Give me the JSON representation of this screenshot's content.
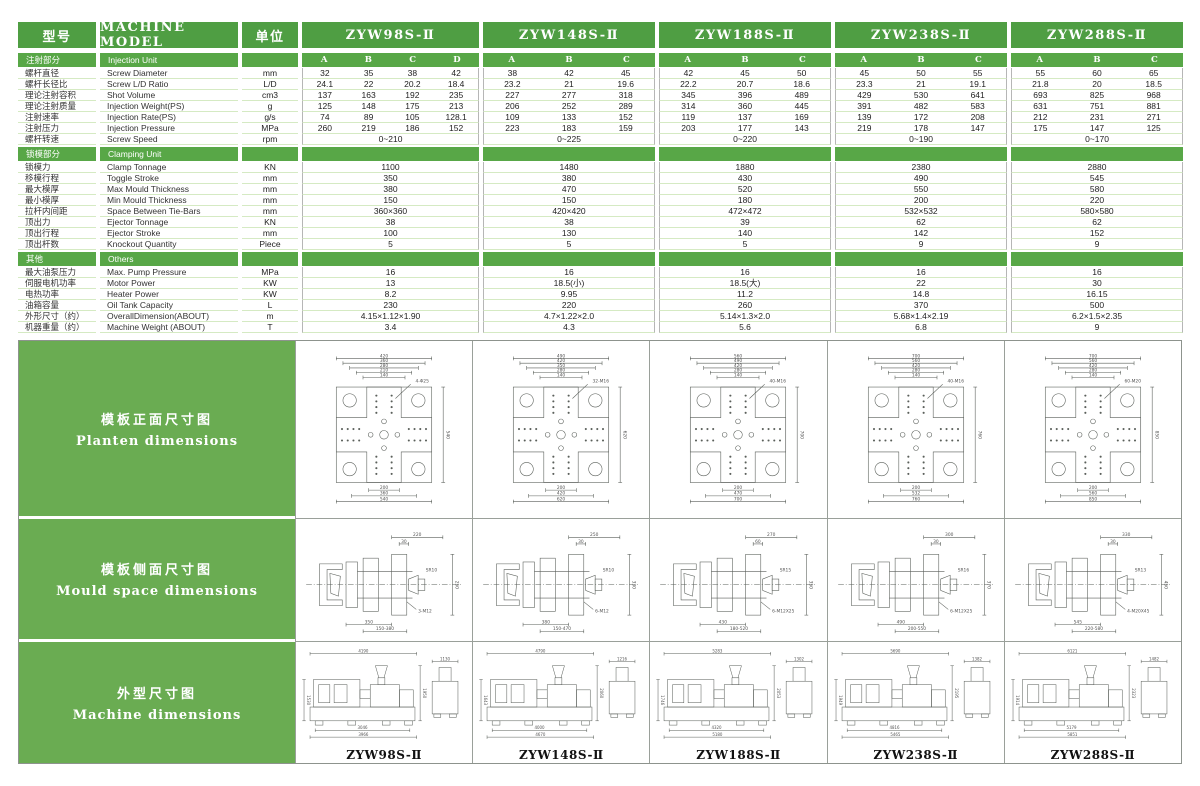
{
  "header": {
    "col_model_cn": "型号",
    "col_model_en": "MACHINE MODEL",
    "col_unit": "单位",
    "models": [
      "ZYW98S-Ⅱ",
      "ZYW148S-Ⅱ",
      "ZYW188S-Ⅱ",
      "ZYW238S-Ⅱ",
      "ZYW288S-Ⅱ"
    ],
    "sub_columns": [
      [
        "A",
        "B",
        "C",
        "D"
      ],
      [
        "A",
        "B",
        "C"
      ],
      [
        "A",
        "B",
        "C"
      ],
      [
        "A",
        "B",
        "C"
      ],
      [
        "A",
        "B",
        "C"
      ]
    ]
  },
  "colors": {
    "header_green": "#4f9e43",
    "band_green": "#58a747",
    "sidebar_green": "#6aac52",
    "row_divider": "#d5eac3"
  },
  "sections": [
    {
      "cn": "注射部分",
      "en": "Injection Unit",
      "letters": true,
      "rows": [
        {
          "cn": "螺杆直径",
          "en": "Screw Diameter",
          "unit": "mm",
          "type": "sub",
          "values": [
            [
              "32",
              "35",
              "38",
              "42"
            ],
            [
              "38",
              "42",
              "45"
            ],
            [
              "42",
              "45",
              "50"
            ],
            [
              "45",
              "50",
              "55"
            ],
            [
              "55",
              "60",
              "65"
            ]
          ]
        },
        {
          "cn": "螺杆长径比",
          "en": "Screw L/D Ratio",
          "unit": "L/D",
          "type": "sub",
          "values": [
            [
              "24.1",
              "22",
              "20.2",
              "18.4"
            ],
            [
              "23.2",
              "21",
              "19.6"
            ],
            [
              "22.2",
              "20.7",
              "18.6"
            ],
            [
              "23.3",
              "21",
              "19.1"
            ],
            [
              "21.8",
              "20",
              "18.5"
            ]
          ]
        },
        {
          "cn": "理论注射容积",
          "en": "Shot Volume",
          "unit": "cm3",
          "type": "sub",
          "values": [
            [
              "137",
              "163",
              "192",
              "235"
            ],
            [
              "227",
              "277",
              "318"
            ],
            [
              "345",
              "396",
              "489"
            ],
            [
              "429",
              "530",
              "641"
            ],
            [
              "693",
              "825",
              "968"
            ]
          ]
        },
        {
          "cn": "理论注射质量",
          "en": "Injection Weight(PS)",
          "unit": "g",
          "type": "sub",
          "values": [
            [
              "125",
              "148",
              "175",
              "213"
            ],
            [
              "206",
              "252",
              "289"
            ],
            [
              "314",
              "360",
              "445"
            ],
            [
              "391",
              "482",
              "583"
            ],
            [
              "631",
              "751",
              "881"
            ]
          ]
        },
        {
          "cn": "注射速率",
          "en": "Injection Rate(PS)",
          "unit": "g/s",
          "type": "sub",
          "values": [
            [
              "74",
              "89",
              "105",
              "128.1"
            ],
            [
              "109",
              "133",
              "152"
            ],
            [
              "119",
              "137",
              "169"
            ],
            [
              "139",
              "172",
              "208"
            ],
            [
              "212",
              "231",
              "271"
            ]
          ]
        },
        {
          "cn": "注射压力",
          "en": "Injection Pressure",
          "unit": "MPa",
          "type": "sub",
          "values": [
            [
              "260",
              "219",
              "186",
              "152"
            ],
            [
              "223",
              "183",
              "159"
            ],
            [
              "203",
              "177",
              "143"
            ],
            [
              "219",
              "178",
              "147"
            ],
            [
              "175",
              "147",
              "125"
            ]
          ]
        },
        {
          "cn": "螺杆转速",
          "en": "Screw Speed",
          "unit": "rpm",
          "type": "merged",
          "values": [
            "0~210",
            "0~225",
            "0~220",
            "0~190",
            "0~170"
          ]
        }
      ]
    },
    {
      "cn": "锁模部分",
      "en": "Clamping Unit",
      "letters": false,
      "rows": [
        {
          "cn": "锁模力",
          "en": "Clamp Tonnage",
          "unit": "KN",
          "type": "merged",
          "values": [
            "1100",
            "1480",
            "1880",
            "2380",
            "2880"
          ]
        },
        {
          "cn": "移模行程",
          "en": "Toggle Stroke",
          "unit": "mm",
          "type": "merged",
          "values": [
            "350",
            "380",
            "430",
            "490",
            "545"
          ]
        },
        {
          "cn": "最大模厚",
          "en": "Max  Mould Thickness",
          "unit": "mm",
          "type": "merged",
          "values": [
            "380",
            "470",
            "520",
            "550",
            "580"
          ]
        },
        {
          "cn": "最小模厚",
          "en": "Min  Mould Thickness",
          "unit": "mm",
          "type": "merged",
          "values": [
            "150",
            "150",
            "180",
            "200",
            "220"
          ]
        },
        {
          "cn": "拉杆内间距",
          "en": "Space Between Tie-Bars",
          "unit": "mm",
          "type": "merged",
          "values": [
            "360×360",
            "420×420",
            "472×472",
            "532×532",
            "580×580"
          ]
        },
        {
          "cn": "顶出力",
          "en": "Ejector Tonnage",
          "unit": "KN",
          "type": "merged",
          "values": [
            "38",
            "38",
            "39",
            "62",
            "62"
          ]
        },
        {
          "cn": "顶出行程",
          "en": "Ejector Stroke",
          "unit": "mm",
          "type": "merged",
          "values": [
            "100",
            "130",
            "140",
            "142",
            "152"
          ]
        },
        {
          "cn": "顶出杆数",
          "en": "Knockout Quantity",
          "unit": "Piece",
          "type": "merged",
          "values": [
            "5",
            "5",
            "5",
            "9",
            "9"
          ]
        }
      ]
    },
    {
      "cn": "其他",
      "en": "Others",
      "letters": false,
      "rows": [
        {
          "cn": "最大油泵压力",
          "en": "Max. Pump Pressure",
          "unit": "MPa",
          "type": "merged",
          "values": [
            "16",
            "16",
            "16",
            "16",
            "16"
          ]
        },
        {
          "cn": "伺服电机功率",
          "en": "Motor Power",
          "unit": "KW",
          "type": "merged",
          "values": [
            "13",
            "18.5(小)",
            "18.5(大)",
            "22",
            "30"
          ]
        },
        {
          "cn": "电热功率",
          "en": "Heater Power",
          "unit": "KW",
          "type": "merged",
          "values": [
            "8.2",
            "9.95",
            "11.2",
            "14.8",
            "16.15"
          ]
        },
        {
          "cn": "油箱容量",
          "en": "Oil Tank Capacity",
          "unit": "L",
          "type": "merged",
          "values": [
            "230",
            "220",
            "260",
            "370",
            "500"
          ]
        },
        {
          "cn": "外形尺寸（约）",
          "en": "OverallDimension(ABOUT)",
          "unit": "m",
          "type": "merged",
          "values": [
            "4.15×1.12×1.90",
            "4.7×1.22×2.0",
            "5.14×1.3×2.0",
            "5.68×1.4×2.19",
            "6.2×1.5×2.35"
          ]
        },
        {
          "cn": "机器重量（约）",
          "en": "Machine Weight (ABOUT)",
          "unit": "T",
          "type": "merged",
          "values": [
            "3.4",
            "4.3",
            "5.6",
            "6.8",
            "9"
          ]
        }
      ]
    }
  ],
  "drawings": {
    "sidebar": [
      {
        "cn": "模板正面尺寸图",
        "en": "Planten  dimensions"
      },
      {
        "cn": "模板侧面尺寸图",
        "en": "Mould  space  dimensions"
      },
      {
        "cn": "外型尺寸图",
        "en": "Machine  dimensions"
      }
    ],
    "footer_models": [
      "ZYW98S-Ⅱ",
      "ZYW148S-Ⅱ",
      "ZYW188S-Ⅱ",
      "ZYW238S-Ⅱ",
      "ZYW288S-Ⅱ"
    ],
    "platen": [
      {
        "top": [
          "420",
          "360",
          "280",
          "210",
          "140"
        ],
        "outer": "540",
        "bottom": [
          "200",
          "360",
          "540"
        ],
        "bolt": "4-Φ25"
      },
      {
        "top": [
          "490",
          "420",
          "350",
          "280",
          "140"
        ],
        "outer": "620",
        "bottom": [
          "200",
          "420",
          "620"
        ],
        "bolt": "32-M16"
      },
      {
        "top": [
          "560",
          "490",
          "420",
          "280",
          "140"
        ],
        "outer": "700",
        "bottom": [
          "200",
          "470",
          "700"
        ],
        "bolt": "40-M16"
      },
      {
        "top": [
          "700",
          "560",
          "420",
          "280",
          "140"
        ],
        "outer": "760",
        "bottom": [
          "200",
          "532",
          "760"
        ],
        "bolt": "40-M16"
      },
      {
        "top": [
          "700",
          "560",
          "420",
          "280",
          "140"
        ],
        "outer": "850",
        "bottom": [
          "200",
          "560",
          "850"
        ],
        "bolt": "60-M20"
      }
    ],
    "mould_space": [
      {
        "top": "220",
        "drop": "30",
        "right": "250",
        "bottom1": "350",
        "bottom2": "150-380",
        "bolt": "3-M12",
        "sr": "SR10"
      },
      {
        "top": "250",
        "drop": "30",
        "right": "330",
        "bottom1": "380",
        "bottom2": "150-470",
        "bolt": "6-M12",
        "sr": "SR10"
      },
      {
        "top": "270",
        "drop": "60",
        "right": "350",
        "bottom1": "430",
        "bottom2": "180-520",
        "bolt": "6-M12X25",
        "sr": "SR15"
      },
      {
        "top": "300",
        "drop": "30",
        "right": "370",
        "bottom1": "490",
        "bottom2": "200-550",
        "bolt": "6-M12X25",
        "sr": "SR16"
      },
      {
        "top": "330",
        "drop": "30",
        "right": "450",
        "bottom1": "545",
        "bottom2": "220-580",
        "bolt": "4-M20X45",
        "sr": "SR13"
      }
    ],
    "machine": [
      {
        "length": "4190",
        "height": "1950",
        "height2": "1530",
        "base": "3966",
        "base2": "3046",
        "end_w": "1130"
      },
      {
        "length": "4790",
        "height": "2060",
        "height2": "1643",
        "base": "4670",
        "base2": "4000",
        "end_w": "1216"
      },
      {
        "length": "5283",
        "height": "2053",
        "height2": "1746",
        "base": "5180",
        "base2": "4320",
        "end_w": "1302"
      },
      {
        "length": "5690",
        "height": "2195",
        "height2": "1949",
        "base": "5465",
        "base2": "4816",
        "end_w": "1382"
      },
      {
        "length": "6121",
        "height": "2323",
        "height2": "1914",
        "base": "5851",
        "base2": "5179",
        "end_w": "1482"
      }
    ]
  }
}
